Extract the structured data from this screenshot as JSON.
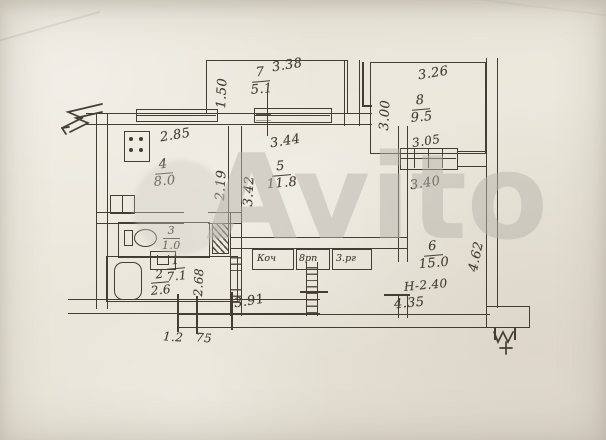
{
  "meta": {
    "watermark": "Avito"
  },
  "colors": {
    "paper": "#e9e4d8",
    "ink": "#443d33",
    "watermark": "#b7b4ac"
  },
  "rooms": {
    "hall": {
      "num": "1",
      "area": "7.1"
    },
    "bath": {
      "num": "2",
      "area": "2.6"
    },
    "wc": {
      "num": "3",
      "area": "1.0"
    },
    "kitchen": {
      "num": "4",
      "area": "8.0"
    },
    "room5": {
      "num": "5",
      "area": "11.8"
    },
    "room6": {
      "num": "6",
      "area": "15.0",
      "height_note": "Н-2.40"
    },
    "balcony": {
      "num": "7",
      "area": "5.1"
    },
    "room8": {
      "num": "8",
      "area": "9.5"
    }
  },
  "dims": {
    "balcony_top": "3.38",
    "balcony_side": "1.50",
    "room8_top": "3.26",
    "room8_side": "3.00",
    "room8_bottom": "3.05",
    "corridor": "3.40",
    "kitchen_top": "2.85",
    "kitchen_side": "2.19",
    "room5_top": "3.44",
    "room5_side": "3.42",
    "room6_right": "4.62",
    "room6_bottom": "4.35",
    "bath_side": "2.68",
    "hall_bottom": "3.91",
    "small_left": "1.2",
    "small_right": "75"
  },
  "closets": [
    "Коч",
    "8рп",
    "3.рг"
  ]
}
